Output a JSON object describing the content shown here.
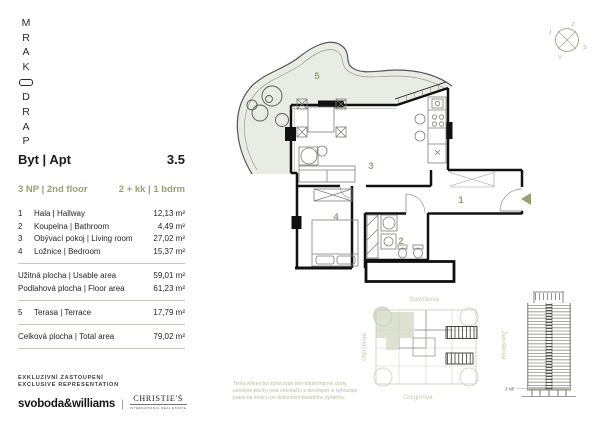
{
  "colors": {
    "accent": "#9aa06e",
    "terrace_fill": "#e9ece2",
    "site_highlight": "#dde1d0",
    "wall": "#111111"
  },
  "logo": {
    "letters": [
      "M",
      "R",
      "A",
      "K",
      "D",
      "R",
      "A",
      "P"
    ]
  },
  "compass": {
    "north": "S",
    "south": "J",
    "east": "V",
    "west": "Z"
  },
  "panel": {
    "header_label": "Byt | Apt",
    "header_value": "3.5",
    "floor": "3 NP | 2nd floor",
    "layout": "2 + kk | 1 bdrm",
    "rooms": [
      {
        "num": "1",
        "name": "Hala | Hallway",
        "area": "12,13 m²"
      },
      {
        "num": "2",
        "name": "Koupelna | Bathroom",
        "area": "4,49 m²"
      },
      {
        "num": "3",
        "name": "Obývací pokoj | Living room",
        "area": "27,02 m²"
      },
      {
        "num": "4",
        "name": "Ložnice | Bedroom",
        "area": "15,37 m²"
      }
    ],
    "usable": {
      "label": "Užitná plocha | Usable area",
      "value": "59,01 m²"
    },
    "floor_area": {
      "label": "Podlahová plocha | Floor area",
      "value": "61,23 m²"
    },
    "terrace": {
      "num": "5",
      "label": "Terasa | Terrace",
      "value": "17,79 m²"
    },
    "total": {
      "label": "Celková plocha | Total area",
      "value": "79,02 m²"
    }
  },
  "plan": {
    "labels": {
      "hallway": "1",
      "bathroom": "2",
      "living": "3",
      "bedroom": "4",
      "terrace": "5"
    }
  },
  "siteplan": {
    "street_top": "Slavíčkova",
    "street_left": "Ostrčilova",
    "street_right": "Ženíškova",
    "street_bottom": "Gregorova"
  },
  "tower": {
    "floor_marker": "3 NP"
  },
  "footer": {
    "rep_line1": "EXKLUZIVNÍ ZASTOUPENÍ",
    "rep_line2": "EXCLUSIVE REPRESENTATION",
    "brand_primary": "svoboda&williams",
    "brand_separator": "|",
    "brand_secondary": "CHRISTIE'S",
    "brand_secondary_sub": "INTERNATIONAL REAL ESTATE",
    "disclaimer_line1": "Tento výkres byl zpracován pro marketingové účely,",
    "disclaimer_line2": "uvedené plochy jsou orientační a developer si vyhrazuje",
    "disclaimer_line3": "právo na změnu po dokončení fasádního systému."
  }
}
